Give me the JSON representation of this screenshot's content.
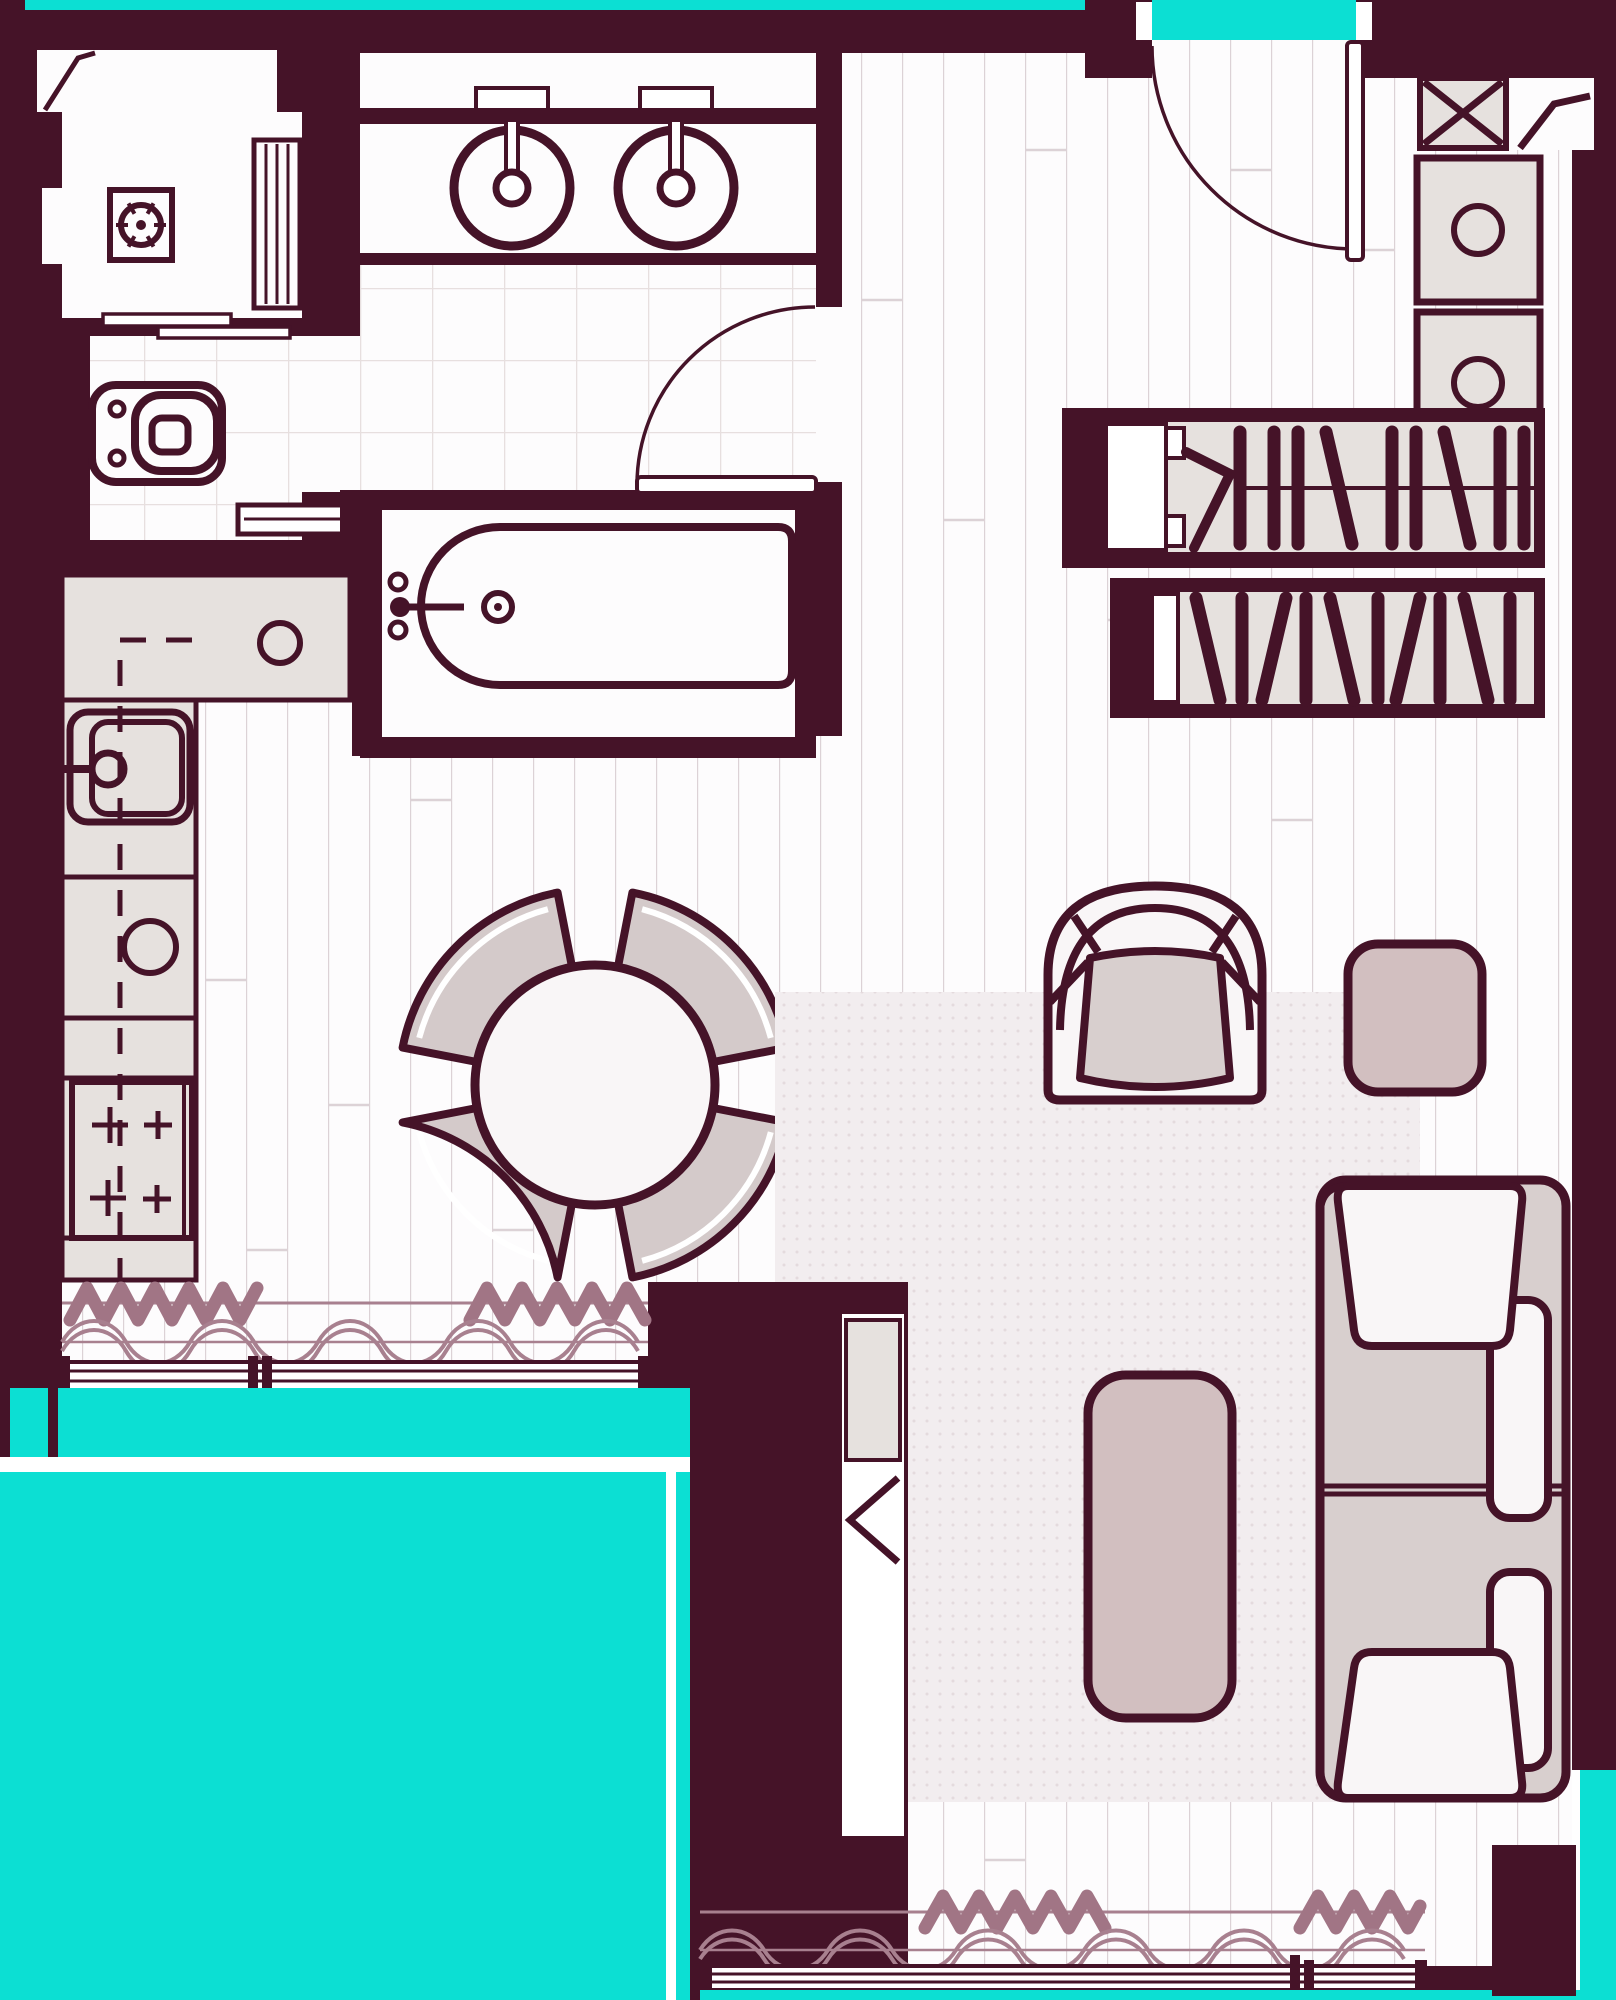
{
  "document": {
    "type": "apartment-floor-plan-drawing",
    "visible_text": [],
    "style": "flat 2D architectural plan, dark maroon walls/outlines, teal exterior, white floors"
  },
  "colors": {
    "wall": "#451328",
    "teal": "#0cdfd3",
    "floor": "#fdfcfd",
    "plank": "#dcd2d6",
    "tile": "#e7dfdf",
    "lightgray": "#e6e1de",
    "seat": "#d8cfce",
    "chair": "#d4caca",
    "mauve": "#d2bfc0",
    "offwhite": "#f9f6f7",
    "rug": "#f2edef",
    "rugdot": "#e4dadd",
    "zig": "#a17585",
    "sine": "#a8808f",
    "white": "#ffffff"
  },
  "inventory": {
    "rooms": [
      "laundry-closet",
      "bathroom-vanity",
      "bathroom",
      "kitchen-dining",
      "entrance-hall",
      "living-room",
      "balcony"
    ],
    "fixtures": [
      {
        "name": "washing-machine",
        "count": 1
      },
      {
        "name": "vanity-vessel-sink",
        "count": 2
      },
      {
        "name": "wall-hung-toilet",
        "count": 1
      },
      {
        "name": "towel-radiator",
        "count": 1
      },
      {
        "name": "bathtub",
        "count": 1
      },
      {
        "name": "kitchen-sink",
        "count": 1
      },
      {
        "name": "cooktop-burner",
        "count": 4
      },
      {
        "name": "dining-table",
        "count": 1
      },
      {
        "name": "dining-chair",
        "count": 4
      },
      {
        "name": "armchair",
        "count": 1
      },
      {
        "name": "side-pouf",
        "count": 1
      },
      {
        "name": "coffee-table",
        "count": 1
      },
      {
        "name": "sofa-seat-section",
        "count": 2
      },
      {
        "name": "rug",
        "count": 1
      },
      {
        "name": "wardrobe-hanging-unit",
        "count": 2
      },
      {
        "name": "cabinet-with-knob",
        "count": 2
      },
      {
        "name": "ventilation-shaft-x",
        "count": 1
      },
      {
        "name": "swing-door",
        "count": 2
      },
      {
        "name": "sliding-door",
        "count": 1
      },
      {
        "name": "window-with-curtain",
        "count": 2
      }
    ]
  }
}
